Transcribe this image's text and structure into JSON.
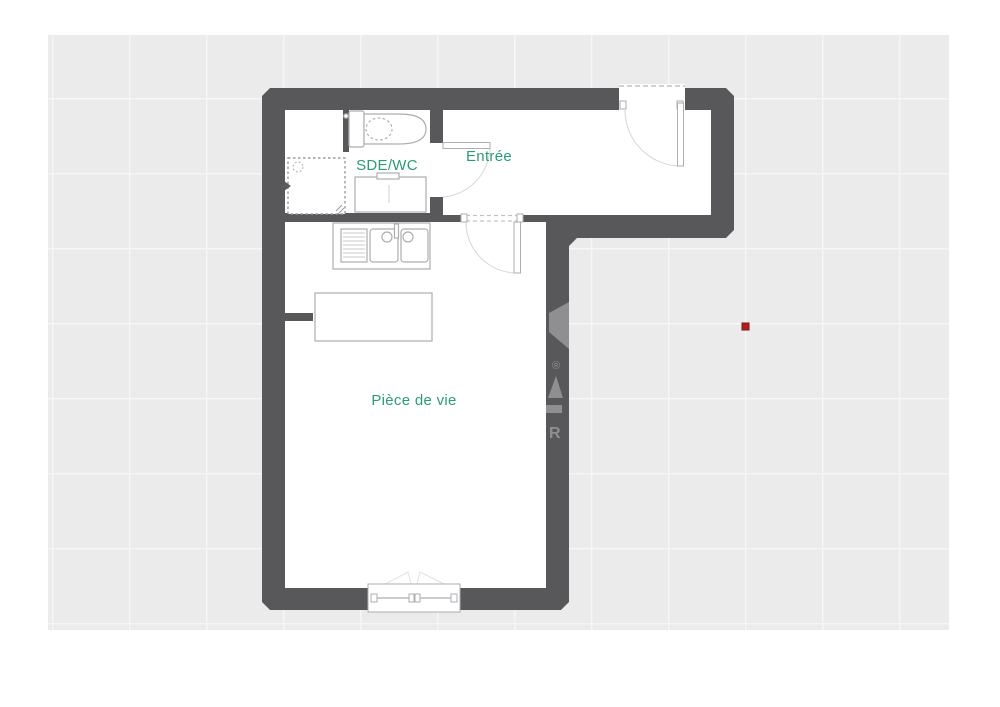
{
  "image": {
    "type": "floor-plan",
    "description": "apartment floor plan on light grey gridded background"
  },
  "rooms": {
    "sde_wc": {
      "label": "SDE/WC"
    },
    "entree": {
      "label": "Entrée"
    },
    "piece_de_vie": {
      "label": "Pièce de vie"
    }
  },
  "fixtures": [
    "toilet",
    "washbasin-unit",
    "shower",
    "kitchen-double-sink",
    "island-counter",
    "window",
    "entrance-door",
    "interior-door-sde",
    "interior-door-living"
  ],
  "watermark": {
    "registered_symbol": "®",
    "letter": "R"
  },
  "markers": {
    "red_dot": {
      "x": 745,
      "y": 327
    }
  },
  "colors": {
    "wall": "#58585a",
    "background": "#ebebeb",
    "grid_line": "#f6f6f6",
    "floor": "#ffffff",
    "room_label": "#2a9c77",
    "furniture_stroke": "#aeaeb0",
    "arc_stroke": "#d6d6d6",
    "dash_stroke": "#c2c2c2",
    "watermark": "#8f8f92",
    "marker": "#ab1e22"
  }
}
